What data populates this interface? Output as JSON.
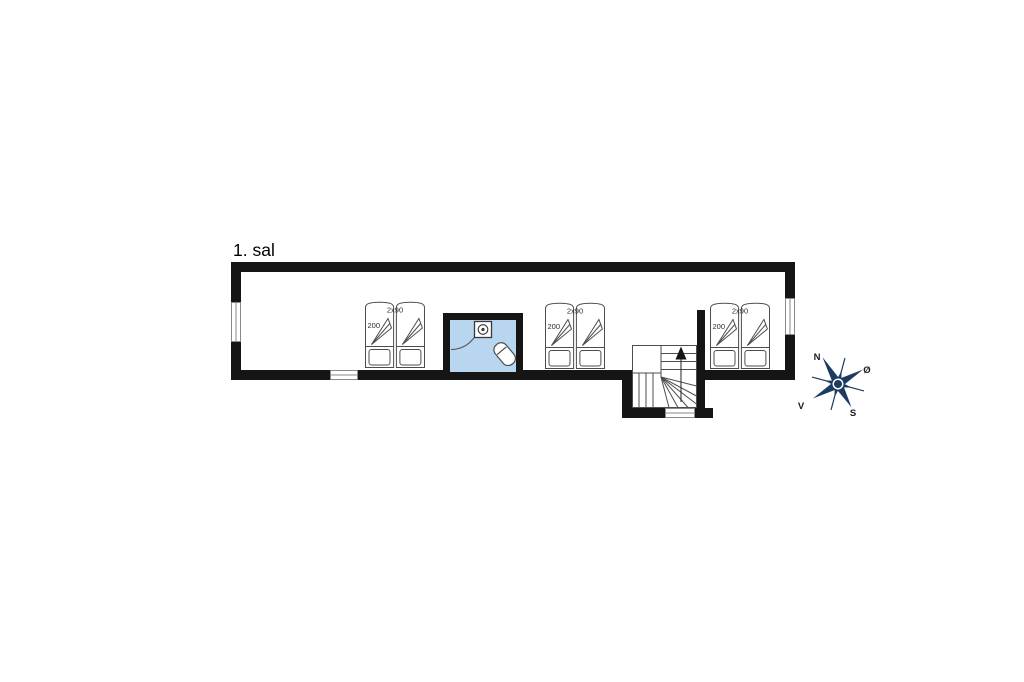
{
  "floorplan": {
    "title": "1. sal",
    "bed_units": [
      {
        "width_label": "2x90",
        "length_label": "200"
      },
      {
        "width_label": "2x90",
        "length_label": "200"
      },
      {
        "width_label": "2x90",
        "length_label": "200"
      }
    ],
    "compass": {
      "north_label": "N",
      "east_label": "Ø",
      "south_label": "S",
      "west_label": "V"
    },
    "colors": {
      "background": "#ffffff",
      "wall": "#151515",
      "outline": "#4d4d4d",
      "window_frame": "#8a8a8a",
      "bathroom_floor": "#b9d6f0",
      "compass": "#1d3b61"
    }
  }
}
